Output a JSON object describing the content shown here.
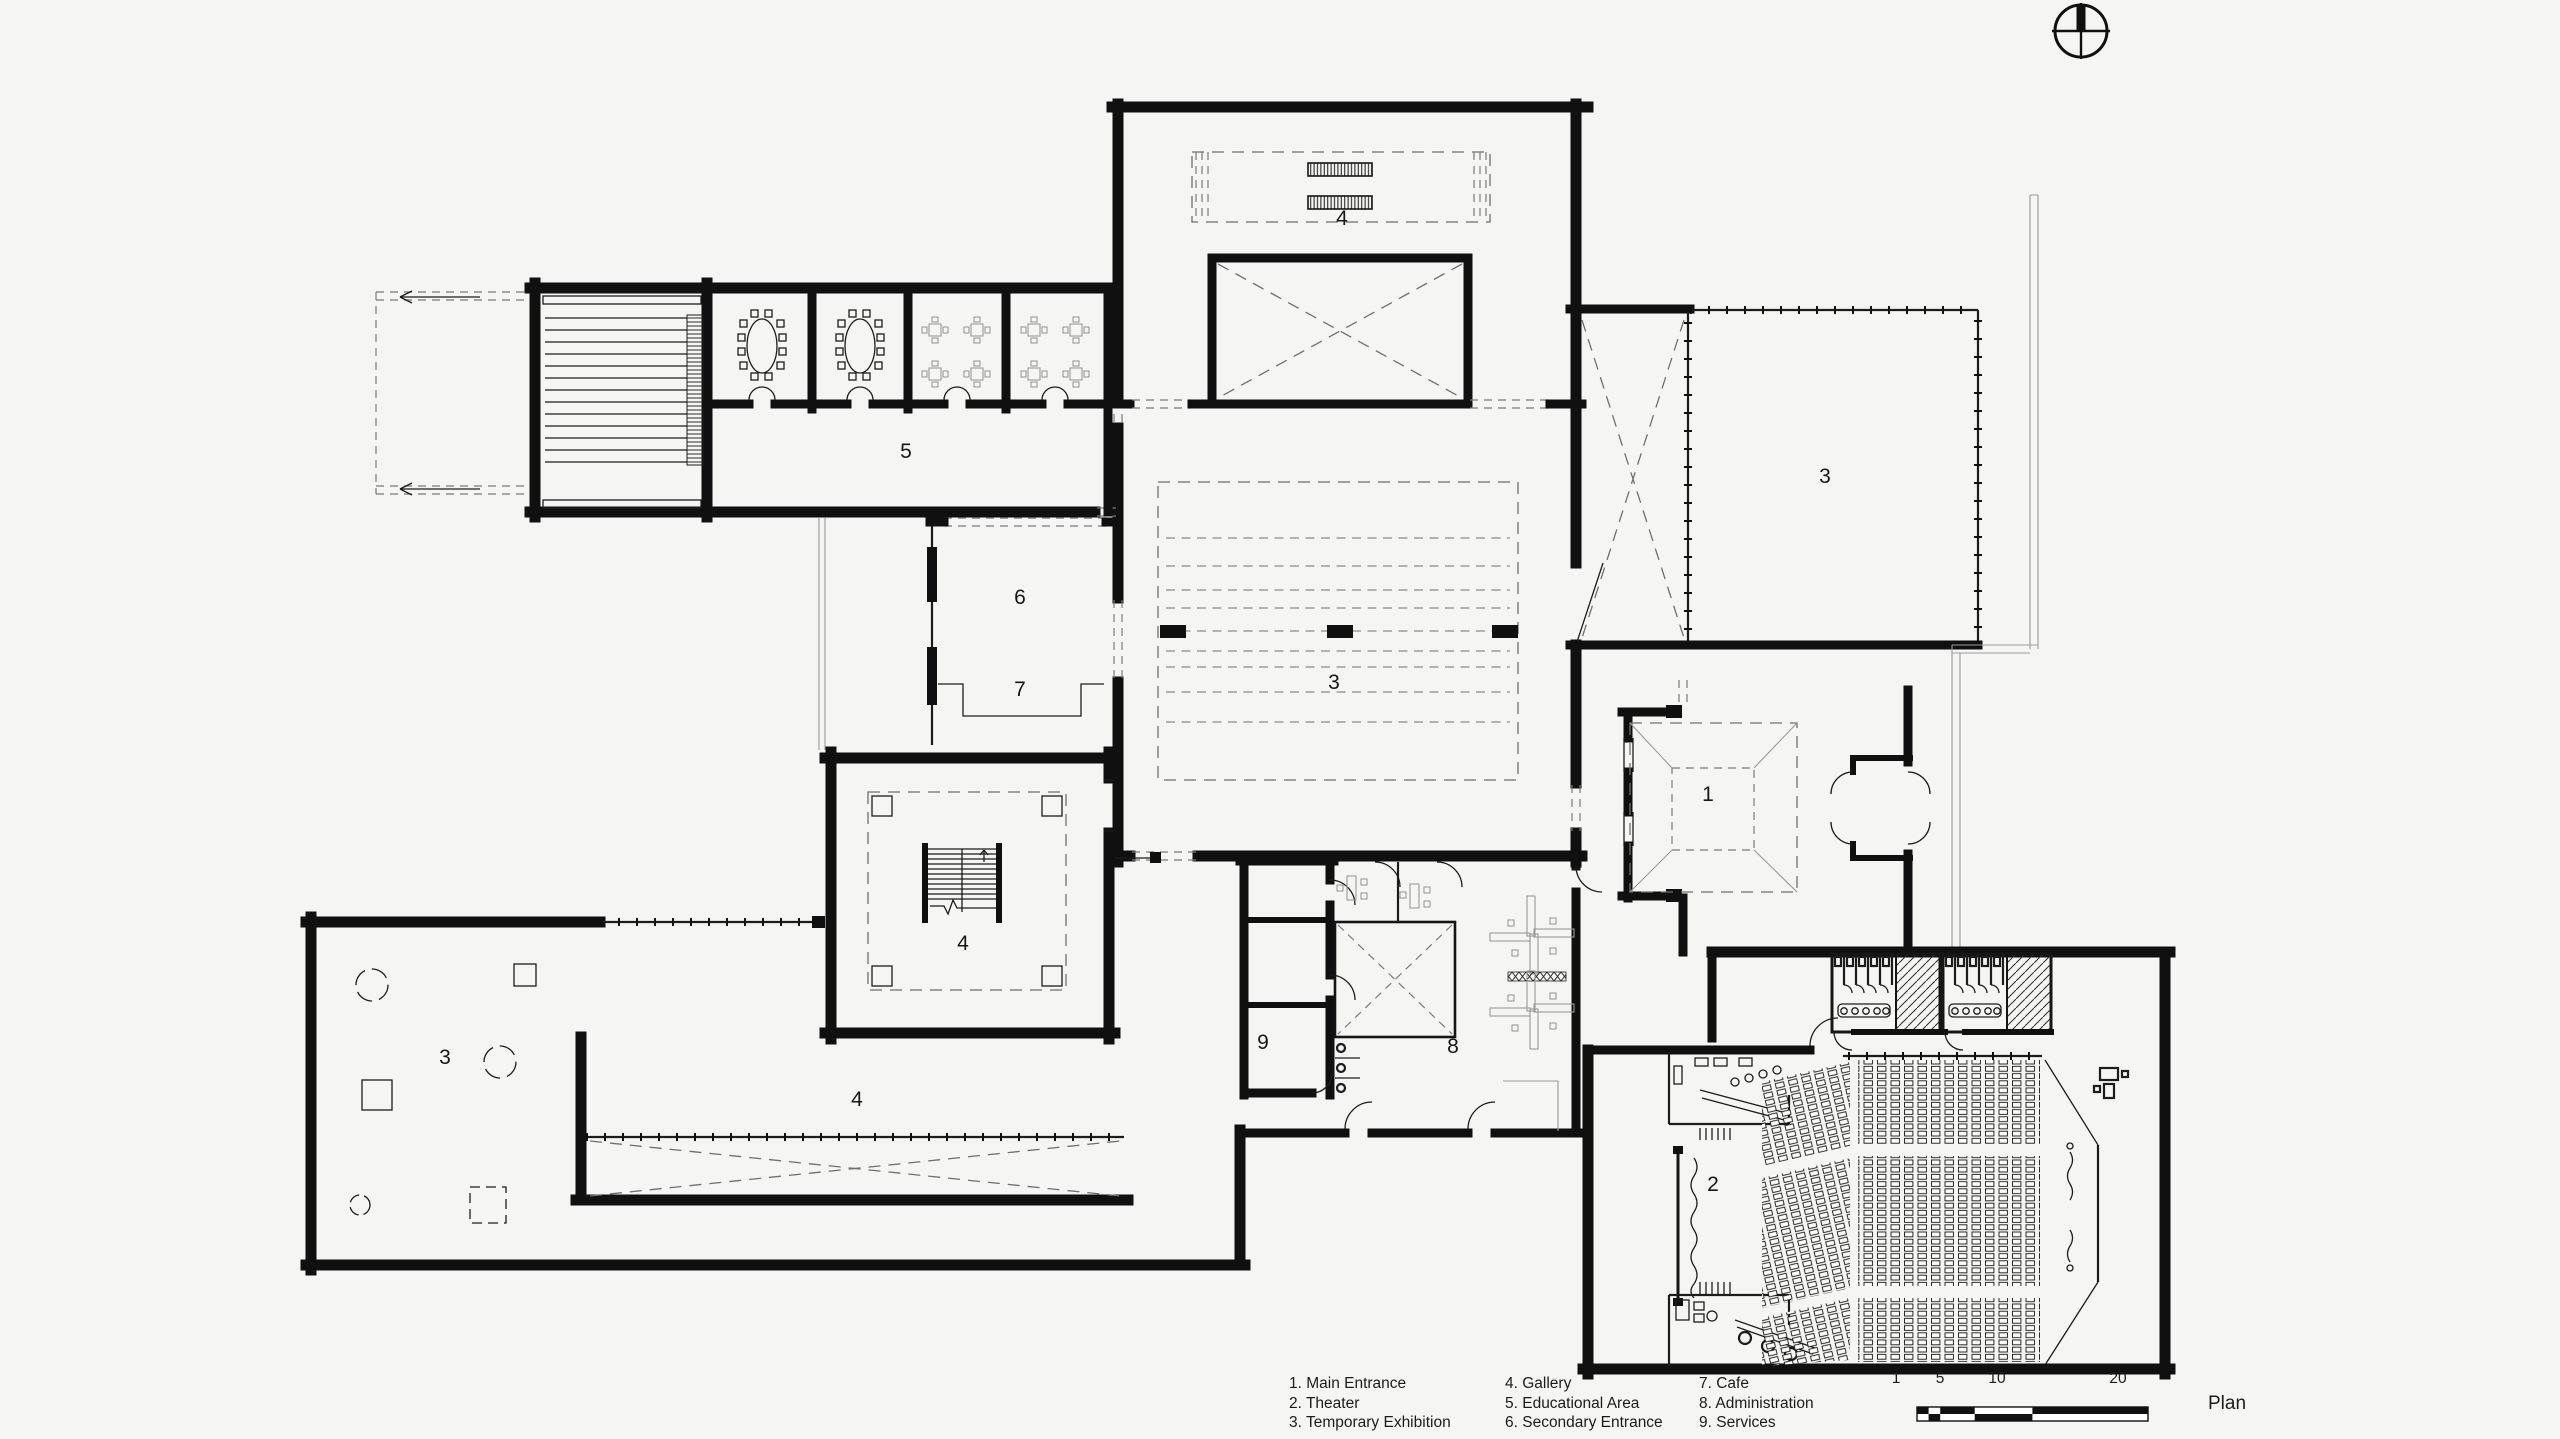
{
  "plan": {
    "title": "Plan",
    "rooms": {
      "labels": [
        {
          "text": "1",
          "x": 1708,
          "y": 795
        },
        {
          "text": "2",
          "x": 1713,
          "y": 1185
        },
        {
          "text": "3",
          "x": 1334,
          "y": 683
        },
        {
          "text": "3",
          "x": 1825,
          "y": 477
        },
        {
          "text": "3",
          "x": 445,
          "y": 1058
        },
        {
          "text": "4",
          "x": 1342,
          "y": 219
        },
        {
          "text": "4",
          "x": 963,
          "y": 944
        },
        {
          "text": "4",
          "x": 857,
          "y": 1100
        },
        {
          "text": "5",
          "x": 906,
          "y": 452
        },
        {
          "text": "6",
          "x": 1020,
          "y": 598
        },
        {
          "text": "7",
          "x": 1020,
          "y": 690
        },
        {
          "text": "8",
          "x": 1453,
          "y": 1047
        },
        {
          "text": "9",
          "x": 1263,
          "y": 1043
        }
      ]
    },
    "legend": {
      "columns": [
        {
          "items": [
            "1. Main Entrance",
            "2. Theater",
            "3. Temporary Exhibition"
          ]
        },
        {
          "items": [
            "4. Gallery",
            "5. Educational Area",
            "6. Secondary Entrance"
          ]
        },
        {
          "items": [
            "7. Cafe",
            "8. Administration",
            "9. Services"
          ]
        }
      ]
    },
    "scalebar": {
      "labels": [
        "1",
        "5",
        "10",
        "20"
      ]
    },
    "colors": {
      "background": "#f5f5f3",
      "line": "#101010",
      "dashed": "#8a8a8a"
    }
  }
}
